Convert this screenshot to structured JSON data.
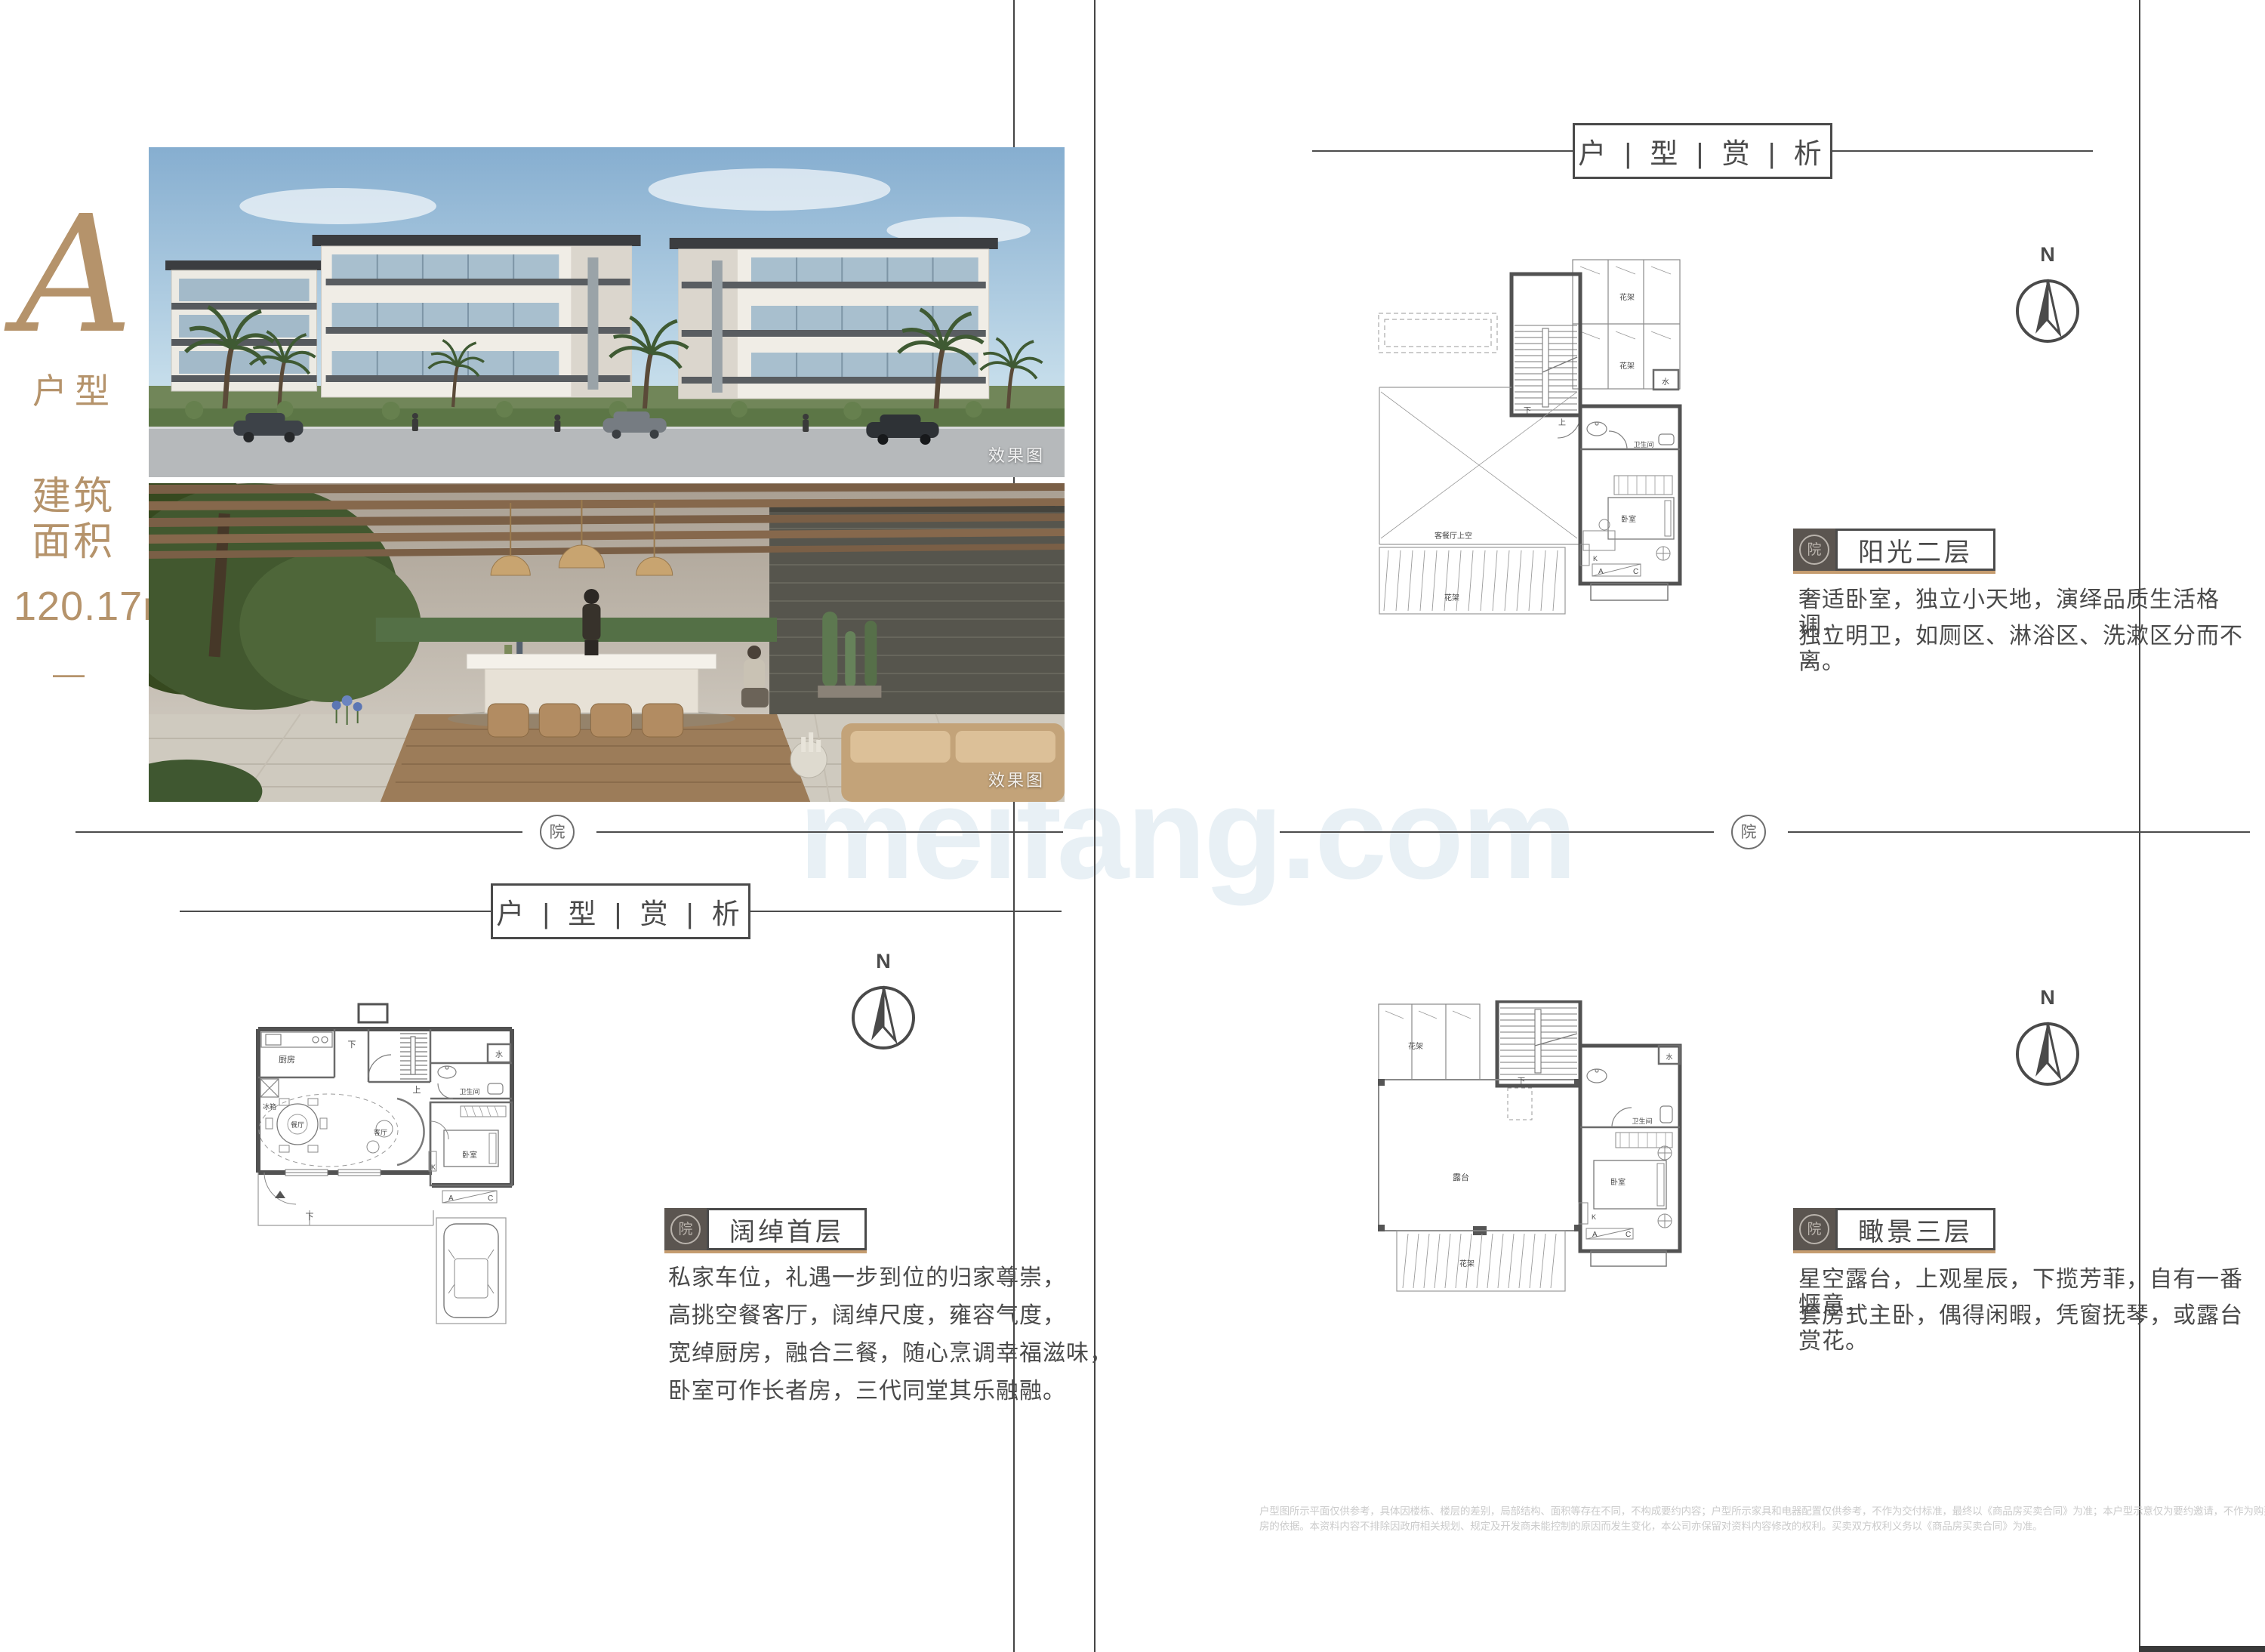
{
  "brand": {
    "type_letter": "A",
    "type_label": "户型",
    "area_line1": "建筑",
    "area_line2": "面积",
    "area_value": "120.17",
    "area_unit": "m",
    "area_unit_sup": "2",
    "dash": "—",
    "seal_char": "院"
  },
  "photos": {
    "tag": "效果图"
  },
  "watermark": "meifang.com",
  "plan_header": "户 | 型 | 赏 | 析",
  "compass_label": "N",
  "sections": {
    "first_floor": {
      "title": "阔绰首层",
      "lines": [
        "私家车位，礼遇一步到位的归家尊崇，",
        "高挑空餐客厅，阔绰尺度，雍容气度，",
        "宽绰厨房，融合三餐，随心烹调幸福滋味，",
        "卧室可作长者房，三代同堂其乐融融。"
      ]
    },
    "second_floor": {
      "title": "阳光二层",
      "lines": [
        "奢适卧室，独立小天地，演绎品质生活格调，",
        "独立明卫，如厕区、淋浴区、洗漱区分而不离。"
      ]
    },
    "third_floor": {
      "title": "瞰景三层",
      "lines": [
        "星空露台，上观星辰，下揽芳菲，自有一番惬意，",
        "套房式主卧，偶得闲暇，凭窗抚琴，或露台赏花。"
      ]
    }
  },
  "room_labels": {
    "kitchen": "厨房",
    "fridge": "冰箱",
    "dining": "餐厅",
    "living": "客厅",
    "bedroom": "卧室",
    "bathroom": "卫生间",
    "water": "水",
    "up": "上",
    "down": "下",
    "flower_rack": "花架",
    "void": "客餐厅上空",
    "terrace": "露台",
    "k": "K",
    "a": "A",
    "c": "C"
  },
  "disclaimer": {
    "line1": "户型图所示平面仅供参考，具体因楼栋、楼层的差别，局部结构、面积等存在不同，不构成要约内容；户型所示家具和电器配置仅供参考，不作为交付标准，最终以《商品房买卖合同》为准；本户型示意仅为要约邀请，不作为购买商品",
    "line2": "房的依据。本资料内容不排除因政府相关规划、规定及开发商未能控制的原因而发生变化，本公司亦保留对资料内容修改的权利。买卖双方权利义务以《商品房买卖合同》为准。"
  },
  "colors": {
    "gold": "#b5936b",
    "ink": "#4a4a4a",
    "tan_underline": "#c59c6f",
    "chip_dark": "#5b5550",
    "disclaimer_gray": "#cbcbcb",
    "watermark_blue": "#e8f0f5"
  }
}
